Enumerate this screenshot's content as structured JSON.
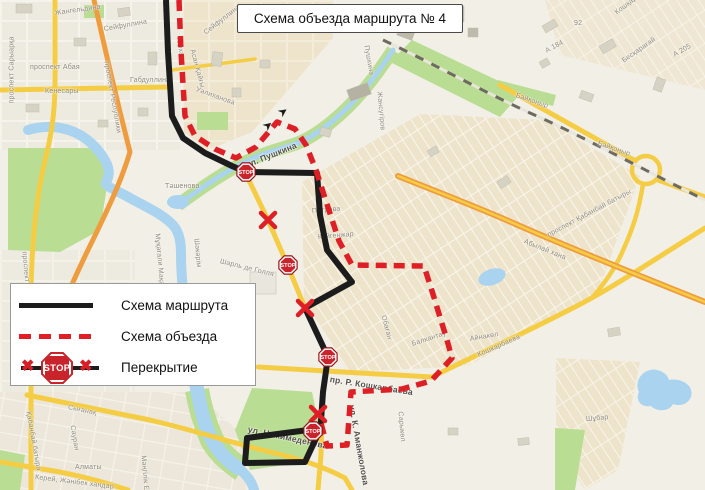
{
  "title": "Схема объезда маршрута № 4",
  "legend": {
    "route_label": "Схема маршрута",
    "detour_label": "Схема объезда",
    "closure_label": "Перекрытие",
    "stop_sign_text": "STOP"
  },
  "colors": {
    "route_black": "#1c1c1c",
    "detour_red": "#df1f26",
    "stop_fill": "#c9242c",
    "road_yellow": "#f5cd45",
    "road_orange": "#ef9c3e",
    "water": "#a9d3ef",
    "park": "#b9dd92",
    "background": "#f2efe7",
    "residential": "#eee4cb",
    "street_label": "#8f8a7b"
  },
  "map": {
    "stop_sign_text": "STOP",
    "route_black_segments": [
      [
        [
          166,
          0
        ],
        [
          168,
          52
        ],
        [
          172,
          116
        ],
        [
          183,
          138
        ],
        [
          205,
          153
        ],
        [
          232,
          166
        ],
        [
          246,
          172
        ],
        [
          317,
          173
        ],
        [
          320,
          215
        ],
        [
          327,
          250
        ],
        [
          352,
          282
        ],
        [
          305,
          308
        ],
        [
          328,
          357
        ],
        [
          323,
          392
        ],
        [
          320,
          435
        ]
      ],
      [
        [
          320,
          430
        ],
        [
          305,
          462
        ],
        [
          245,
          463
        ],
        [
          247,
          438
        ],
        [
          316,
          429
        ]
      ]
    ],
    "route_red": [
      [
        179,
        0
      ],
      [
        181,
        52
      ],
      [
        185,
        116
      ],
      [
        195,
        136
      ],
      [
        215,
        149
      ],
      [
        236,
        158
      ],
      [
        256,
        147
      ],
      [
        277,
        122
      ],
      [
        295,
        129
      ],
      [
        306,
        145
      ],
      [
        316,
        170
      ],
      [
        323,
        192
      ],
      [
        339,
        241
      ],
      [
        352,
        265
      ],
      [
        424,
        266
      ],
      [
        432,
        291
      ],
      [
        447,
        340
      ],
      [
        452,
        358
      ],
      [
        431,
        381
      ],
      [
        402,
        389
      ],
      [
        351,
        392
      ],
      [
        347,
        445
      ],
      [
        327,
        446
      ],
      [
        322,
        427
      ],
      [
        318,
        413
      ]
    ],
    "stop_signs": [
      [
        246,
        172
      ],
      [
        288,
        265
      ],
      [
        328,
        357
      ],
      [
        313,
        431
      ]
    ],
    "closure_marks": [
      [
        268,
        220
      ],
      [
        305,
        308
      ],
      [
        318,
        414
      ]
    ],
    "direction_arrows": [
      {
        "x": 265,
        "y": 128,
        "r": -40
      },
      {
        "x": 280,
        "y": 114,
        "r": -35
      }
    ],
    "street_labels": [
      {
        "t": "Жангельдина",
        "x": 55,
        "y": 10,
        "r": -8
      },
      {
        "t": "Сейфуллина",
        "x": 104,
        "y": 26,
        "r": -10
      },
      {
        "t": "Сейфуллина",
        "x": 205,
        "y": 30,
        "r": -38
      },
      {
        "t": "проспект Абая",
        "x": 30,
        "y": 64,
        "r": 0
      },
      {
        "t": "Кенесары",
        "x": 45,
        "y": 88,
        "r": 0
      },
      {
        "t": "Габдуллина",
        "x": 130,
        "y": 77,
        "r": 0
      },
      {
        "t": "проспект Сарыарқа",
        "x": 12,
        "y": 100,
        "r": -90
      },
      {
        "t": "проспект Республики",
        "x": 106,
        "y": 58,
        "r": 80
      },
      {
        "t": "Асан Қайғы",
        "x": 192,
        "y": 46,
        "r": 75
      },
      {
        "t": "Уәлиханова",
        "x": 196,
        "y": 86,
        "r": 20
      },
      {
        "t": "Тархан",
        "x": 178,
        "y": 33,
        "r": 80
      },
      {
        "t": "ул. Пушкина",
        "x": 246,
        "y": 160,
        "r": -22,
        "s": 2
      },
      {
        "t": "Тәшенова",
        "x": 165,
        "y": 183,
        "r": 0
      },
      {
        "t": "Мұқағали Мақатаева",
        "x": 157,
        "y": 230,
        "r": 85
      },
      {
        "t": "Шәкәрім",
        "x": 196,
        "y": 235,
        "r": 85
      },
      {
        "t": "Шарль де Голля",
        "x": 220,
        "y": 258,
        "r": 14
      },
      {
        "t": "Пушкина",
        "x": 366,
        "y": 42,
        "r": 80
      },
      {
        "t": "Жансүгіров",
        "x": 379,
        "y": 88,
        "r": 85
      },
      {
        "t": "Петрова",
        "x": 312,
        "y": 208,
        "r": -5
      },
      {
        "t": "Күйгенжар",
        "x": 318,
        "y": 234,
        "r": -5
      },
      {
        "t": "Обаған",
        "x": 383,
        "y": 312,
        "r": 75
      },
      {
        "t": "Балкантау",
        "x": 412,
        "y": 341,
        "r": -18
      },
      {
        "t": "Айнакөл",
        "x": 470,
        "y": 336,
        "r": -10
      },
      {
        "t": "пр. Р. Кошкарбаева",
        "x": 330,
        "y": 374,
        "r": 9,
        "s": 2
      },
      {
        "t": "Кошкарбаева",
        "x": 478,
        "y": 352,
        "r": -24
      },
      {
        "t": "ул. Нажимеденова",
        "x": 248,
        "y": 424,
        "r": 12,
        "s": 2
      },
      {
        "t": "ул. К. Аманжолова",
        "x": 352,
        "y": 400,
        "r": 80,
        "s": 2
      },
      {
        "t": "Сарыкөл",
        "x": 400,
        "y": 408,
        "r": 85
      },
      {
        "t": "Сығанақ",
        "x": 68,
        "y": 404,
        "r": 12
      },
      {
        "t": "Алматы",
        "x": 75,
        "y": 464,
        "r": 0
      },
      {
        "t": "Мәңгілік Ел",
        "x": 143,
        "y": 452,
        "r": 85
      },
      {
        "t": "Керей, Жәнібек хандар",
        "x": 35,
        "y": 474,
        "r": 7
      },
      {
        "t": "проспект Тұран",
        "x": 24,
        "y": 248,
        "r": 85
      },
      {
        "t": "Қабанбай батыра",
        "x": 28,
        "y": 408,
        "r": 80
      },
      {
        "t": "Сауран",
        "x": 72,
        "y": 422,
        "r": 80
      },
      {
        "t": "проспект Қабанбай батыры",
        "x": 548,
        "y": 232,
        "r": -28
      },
      {
        "t": "Абылай хана",
        "x": 524,
        "y": 238,
        "r": 22
      },
      {
        "t": "А 184",
        "x": 546,
        "y": 48,
        "r": -28
      },
      {
        "t": "А 205",
        "x": 674,
        "y": 52,
        "r": -30
      },
      {
        "t": "92",
        "x": 574,
        "y": 20,
        "r": 0
      },
      {
        "t": "Байқоңыр",
        "x": 516,
        "y": 92,
        "r": 19
      },
      {
        "t": "Байқоңыр",
        "x": 598,
        "y": 140,
        "r": 19
      },
      {
        "t": "Кошқарбаева",
        "x": 616,
        "y": 10,
        "r": -38
      },
      {
        "t": "Бесқарағай",
        "x": 623,
        "y": 58,
        "r": -35
      },
      {
        "t": "Шұбар",
        "x": 586,
        "y": 416,
        "r": -5
      }
    ]
  }
}
